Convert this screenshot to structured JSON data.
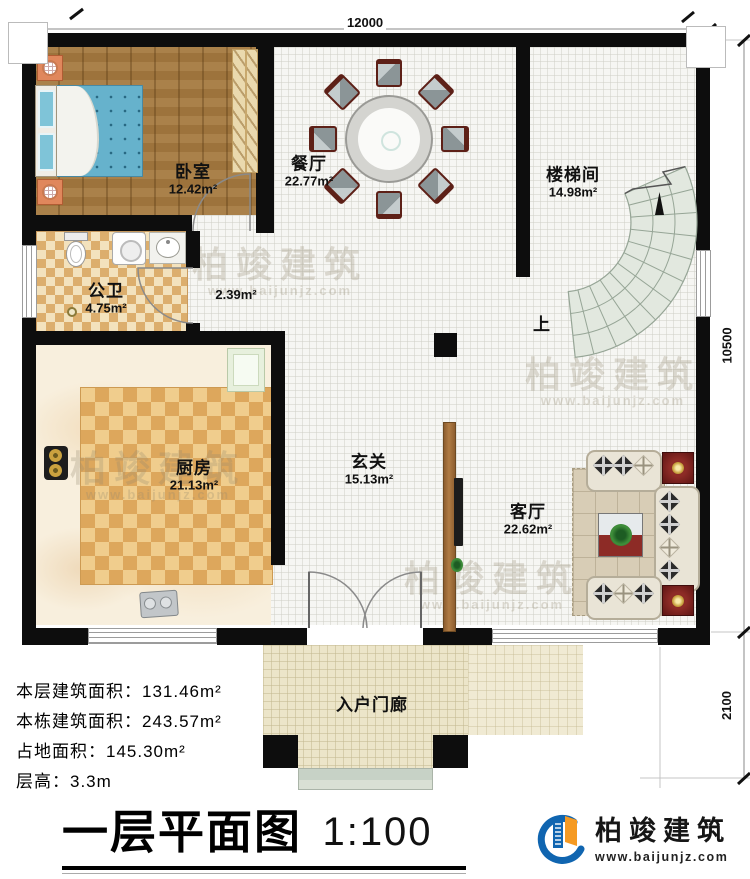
{
  "dimensions": {
    "top": "12000",
    "right_upper": "10500",
    "right_lower": "2100"
  },
  "rooms": {
    "bedroom": {
      "name": "卧室",
      "area": "12.42m²"
    },
    "dining": {
      "name": "餐厅",
      "area": "22.77m²"
    },
    "stairwell": {
      "name": "楼梯间",
      "area": "14.98m²"
    },
    "bathroom": {
      "name": "公卫",
      "area": "4.75m²"
    },
    "corridor": {
      "area": "2.39m²"
    },
    "kitchen": {
      "name": "厨房",
      "area": "21.13m²"
    },
    "foyer": {
      "name": "玄关",
      "area": "15.13m²"
    },
    "living": {
      "name": "客厅",
      "area": "22.62m²"
    },
    "porch": {
      "name": "入户门廊"
    }
  },
  "stairs": {
    "direction_label": "上"
  },
  "info": {
    "lines": [
      "本层建筑面积：131.46m²",
      "本栋建筑面积：243.57m²",
      "占地面积：145.30m²",
      "层高：3.3m"
    ]
  },
  "title": {
    "text": "一层平面图",
    "scale": "1:100"
  },
  "brand": {
    "name": "柏竣建筑",
    "url": "www.baijunjz.com"
  },
  "watermark": {
    "text": "柏竣建筑",
    "url": "www.baijunjz.com"
  },
  "colors": {
    "wall": "#0d0d0d",
    "brand_blue": "#1065b0",
    "brand_orange": "#f59a23",
    "stair_fill": "#e2e8df"
  }
}
